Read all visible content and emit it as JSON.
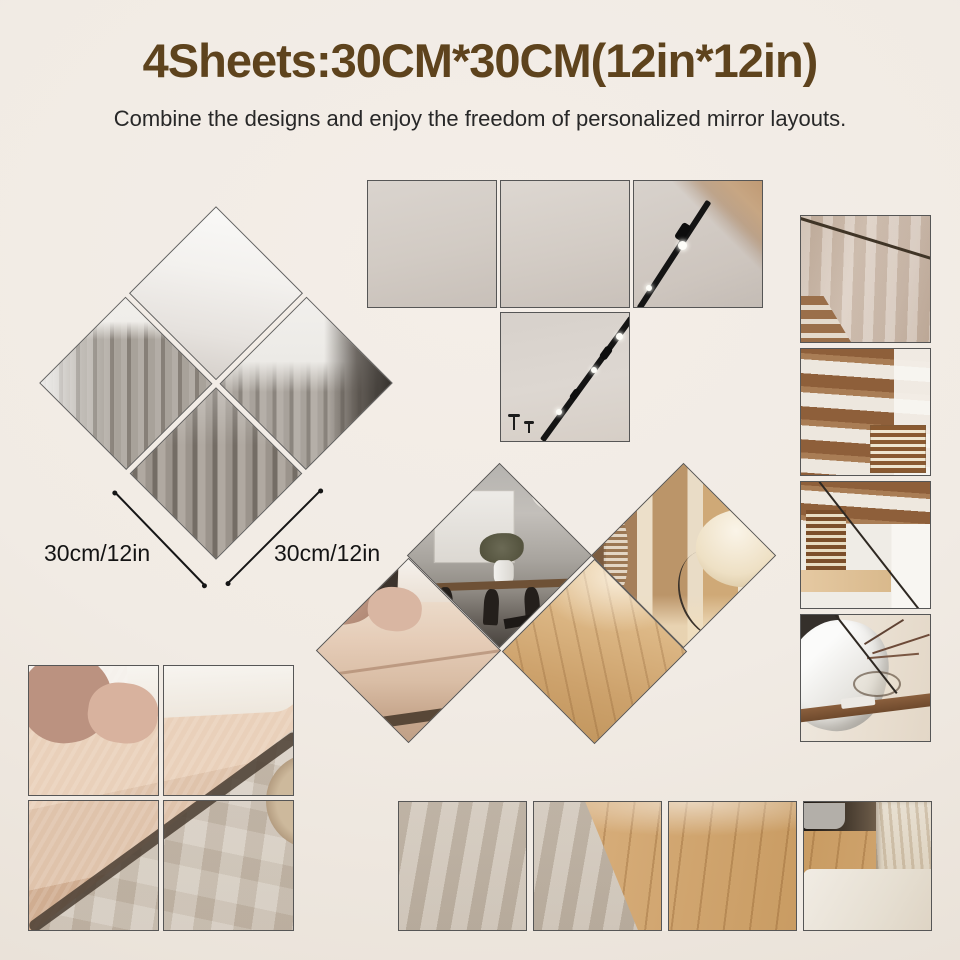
{
  "header": {
    "title": "4Sheets:30CM*30CM(12in*12in)",
    "subtitle": "Combine the designs and enjoy the freedom of personalized mirror layouts."
  },
  "dimensions": {
    "left_label": "30cm/12in",
    "right_label": "30cm/12in"
  },
  "colors": {
    "background": "#f1ebe4",
    "title_brown": "#5e431d",
    "subtitle_text": "#282828",
    "label_text": "#141414",
    "tile_border": "#565656"
  }
}
